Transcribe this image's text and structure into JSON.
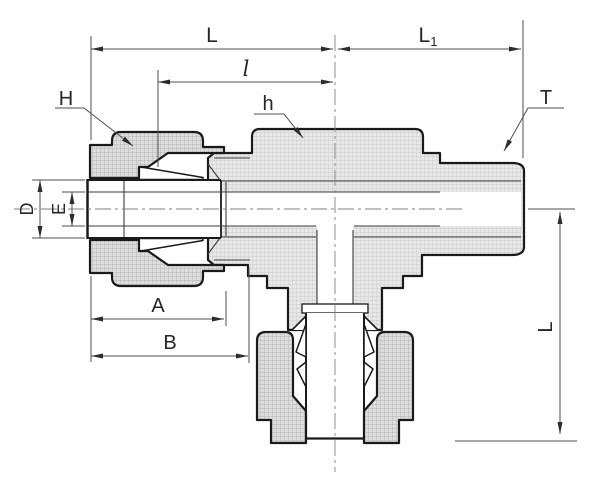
{
  "drawing": {
    "description": "sectioned technical drawing of a male run tee tube fitting with two compression nuts and one male threaded end",
    "labels": {
      "L_top": "L",
      "l_small": "l",
      "L1_base": "L",
      "L1_sub": "1",
      "H": "H",
      "h": "h",
      "T": "T",
      "D": "D",
      "E": "E",
      "A": "A",
      "B": "B",
      "L_vertical": "L"
    },
    "colors": {
      "background": "#ffffff",
      "outline": "#1a1a1a",
      "dimension_lines": "#4f4f4f",
      "hatch_body": "#e8e8e8",
      "hatch_body_grid": "#c9c9c9",
      "hatch_nut": "#dddddd",
      "hatch_nut_grid": "#b3b3b3"
    }
  }
}
